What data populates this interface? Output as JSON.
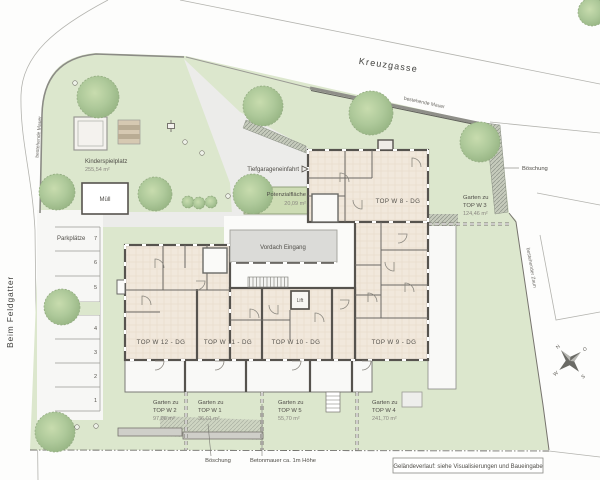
{
  "plan": {
    "streets": {
      "top": "Kreuzgasse",
      "left": "Beim Feldgatter"
    },
    "annotations": {
      "wall_left": "bestehende Mauer",
      "wall_top": "bestehende Mauer",
      "fence_right": "bestehender Zaun",
      "slope_right": "Böschung",
      "slope_bottom": "Böschung",
      "concrete_wall": "Betonmauer ca. 1m Höhe",
      "note": "Geländeverlauf: siehe Visualisierungen und Baueingabe"
    },
    "playground": {
      "name": "Kinderspielplatz",
      "area": "255,54 m²",
      "waste": "Müll"
    },
    "parking": {
      "label": "Parkplätze",
      "spaces": [
        "7",
        "6",
        "5",
        "4",
        "3",
        "2",
        "1"
      ]
    },
    "garage": {
      "entry": "Tiefgarageneinfahrt",
      "potential_name": "Potenzialfläche",
      "potential_area": "20,09 m²"
    },
    "building": {
      "canopy": "Vordach Eingang",
      "lift": "Lift",
      "units": [
        {
          "label": "TOP W 8 - DG"
        },
        {
          "label": "TOP W 9 - DG"
        },
        {
          "label": "TOP W 10 - DG"
        },
        {
          "label": "TOP W 11 - DG"
        },
        {
          "label": "TOP W 12 - DG"
        }
      ]
    },
    "gardens": [
      {
        "l1": "Garten zu",
        "l2": "TOP W 2",
        "area": "97,06 m²"
      },
      {
        "l1": "Garten zu",
        "l2": "TOP W 1",
        "area": "36,01 m²"
      },
      {
        "l1": "Garten zu",
        "l2": "TOP W 5",
        "area": "55,70 m²"
      },
      {
        "l1": "Garten zu",
        "l2": "TOP W 4",
        "area": "241,70 m²"
      },
      {
        "l1": "Garten zu",
        "l2": "TOP W 3",
        "area": "124,46 m²"
      }
    ],
    "compass": {
      "n": "N",
      "e": "O",
      "s": "S",
      "w": "W"
    }
  }
}
